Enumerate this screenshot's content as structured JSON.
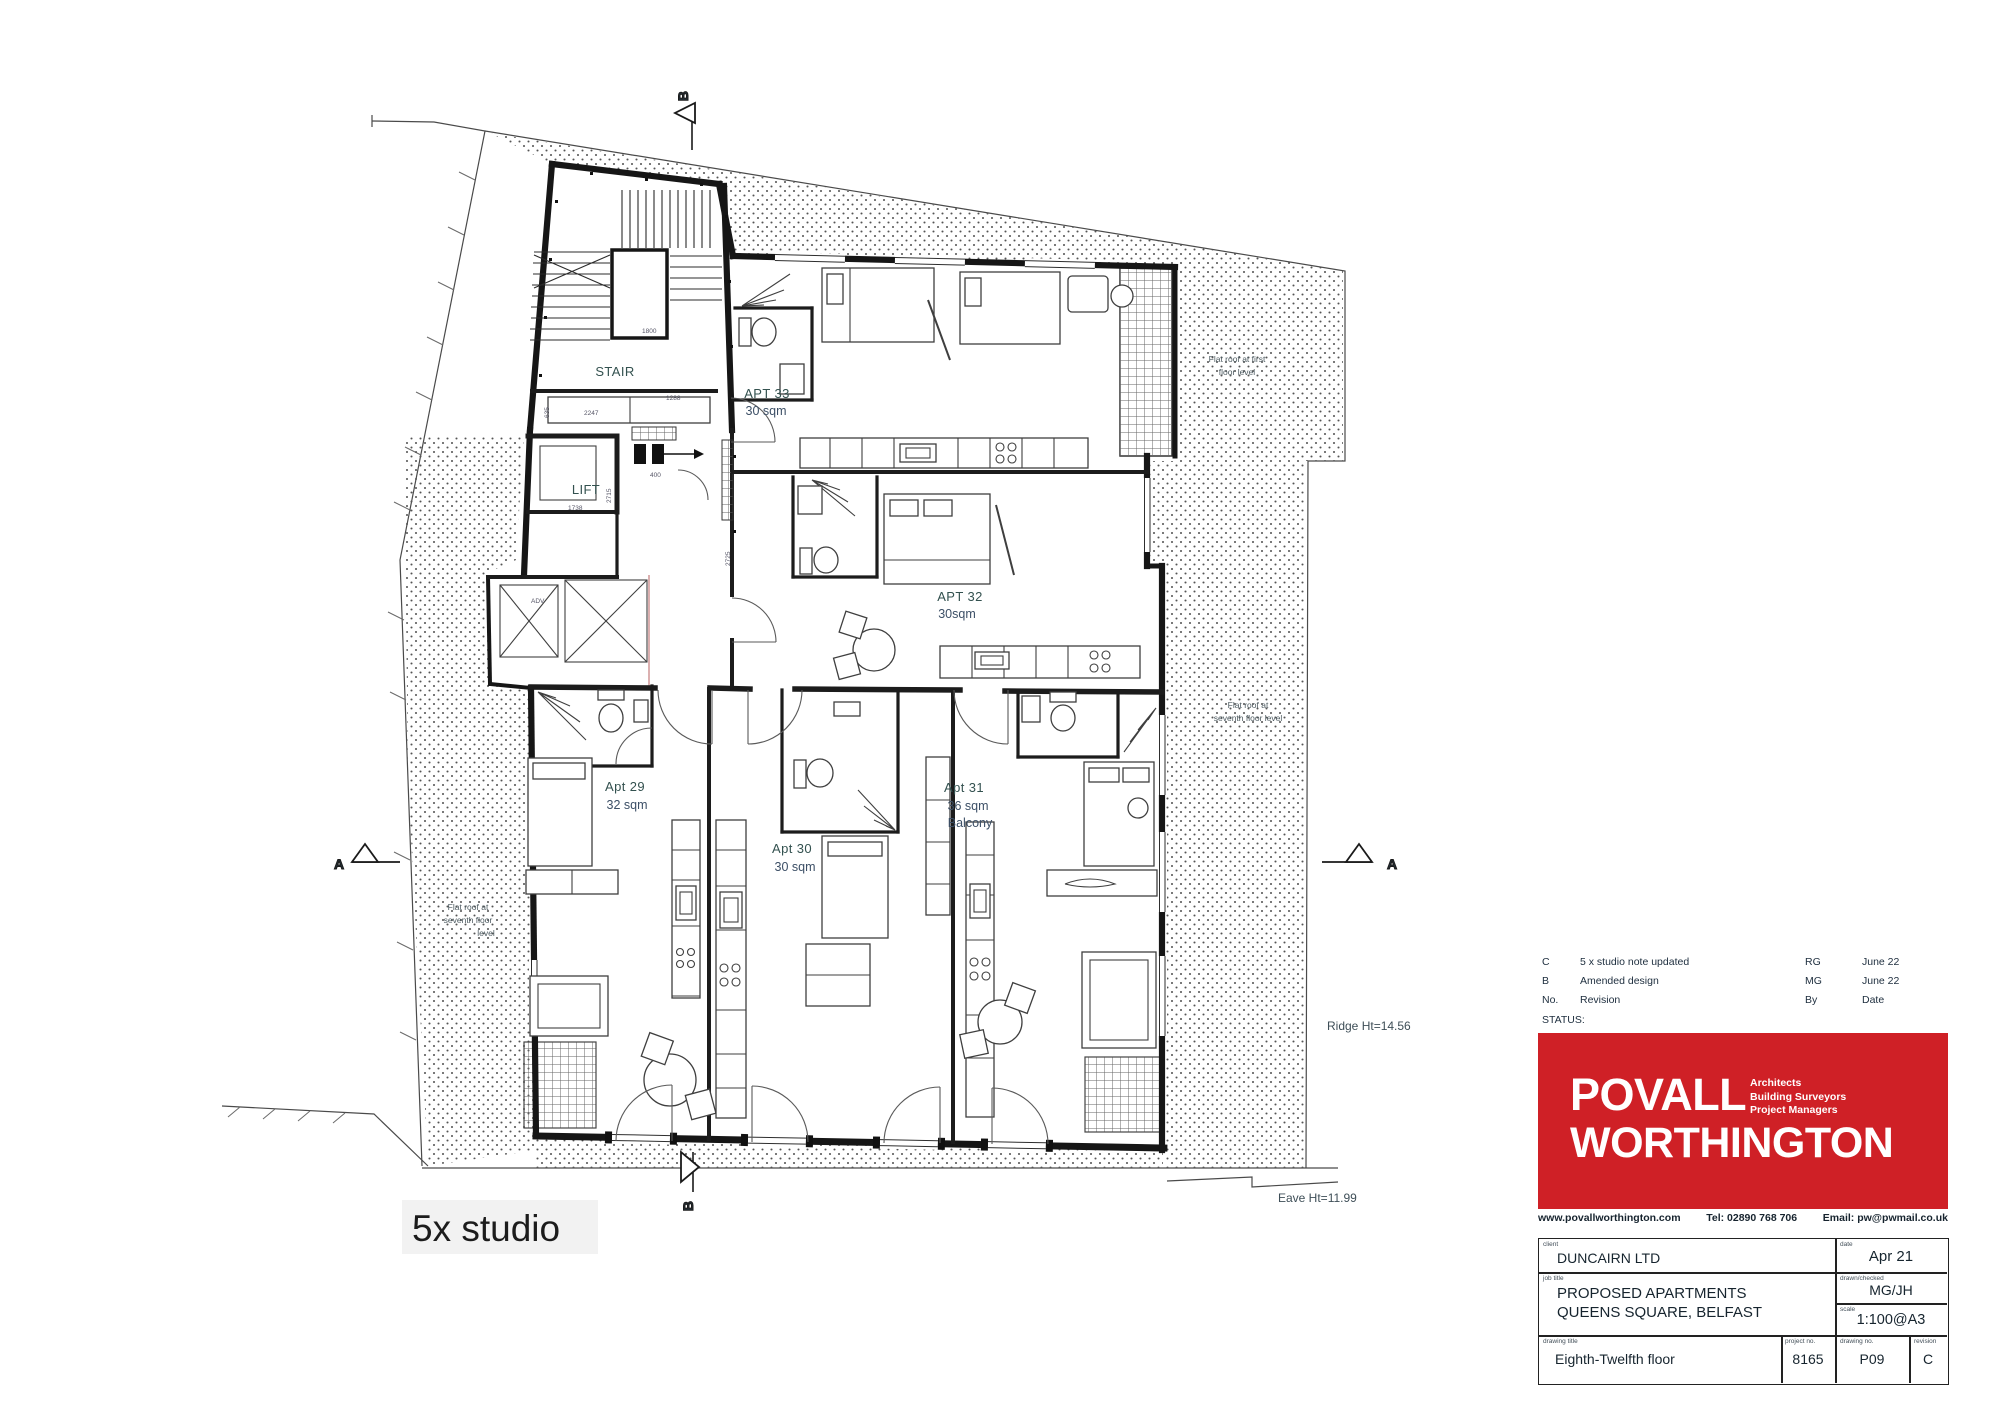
{
  "plan": {
    "summary_note": "5x studio",
    "rooms": {
      "stair": {
        "label": "STAIR"
      },
      "lift": {
        "label": "LIFT"
      },
      "apt33": {
        "name": "APT 33",
        "area": "30 sqm"
      },
      "apt32": {
        "name": "APT 32",
        "area": "30sqm"
      },
      "apt29": {
        "name": "Apt 29",
        "area": "32 sqm"
      },
      "apt30": {
        "name": "Apt 30",
        "area": "30 sqm"
      },
      "apt31": {
        "name": "Apt 31",
        "area": "36 sqm",
        "note": "Balcony"
      }
    },
    "annotations": {
      "flat_roof_first": [
        "Flat roof at first",
        "floor level"
      ],
      "flat_roof_seventh_right": [
        "Flat roof at",
        "seventh floor level"
      ],
      "flat_roof_seventh_left": [
        "Flat roof at",
        "seventh floor",
        "level"
      ],
      "ridge_height": "Ridge Ht=14.56",
      "eave_height": "Eave Ht=11.99"
    },
    "section_markers": {
      "a": "A",
      "b": "B"
    },
    "dimensions": {
      "stair_landing": "1800",
      "stair_flight": "1288",
      "lobby_width": "2247",
      "lobby_side": "635",
      "lift_width": "1738",
      "lift_depth": "2715",
      "corridor": "2725",
      "door": "400",
      "duct": "ADV"
    }
  },
  "titleblock": {
    "revisions": [
      {
        "no": "C",
        "desc": "5 x studio note updated",
        "by": "RG",
        "date": "June 22"
      },
      {
        "no": "B",
        "desc": "Amended design",
        "by": "MG",
        "date": "June 22"
      }
    ],
    "rev_headers": {
      "no": "No.",
      "revision": "Revision",
      "by": "By",
      "date": "Date"
    },
    "status_label": "STATUS:",
    "logo": {
      "line1": "POVALL",
      "line2": "WORTHINGTON",
      "services": [
        "Architects",
        "Building Surveyors",
        "Project Managers"
      ],
      "red": "#cf2026"
    },
    "contact": {
      "web": "www.povallworthington.com",
      "tel": "Tel: 02890 768 706",
      "email": "Email: pw@pwmail.co.uk"
    },
    "fields": {
      "client_label": "client",
      "client": "DUNCAIRN LTD",
      "date_label": "date",
      "date": "Apr 21",
      "job_label": "job title",
      "job1": "PROPOSED APARTMENTS",
      "job2": "QUEENS SQUARE, BELFAST",
      "drawn_label": "drawn/checked",
      "drawn": "MG/JH",
      "scale_label": "scale",
      "scale": "1:100@A3",
      "dwgtitle_label": "drawing title",
      "dwgtitle": "Eighth-Twelfth floor",
      "project_label": "project no.",
      "project": "8165",
      "dwgno_label": "drawing no.",
      "dwgno": "P09",
      "rev_label": "revision",
      "rev": "C"
    }
  }
}
